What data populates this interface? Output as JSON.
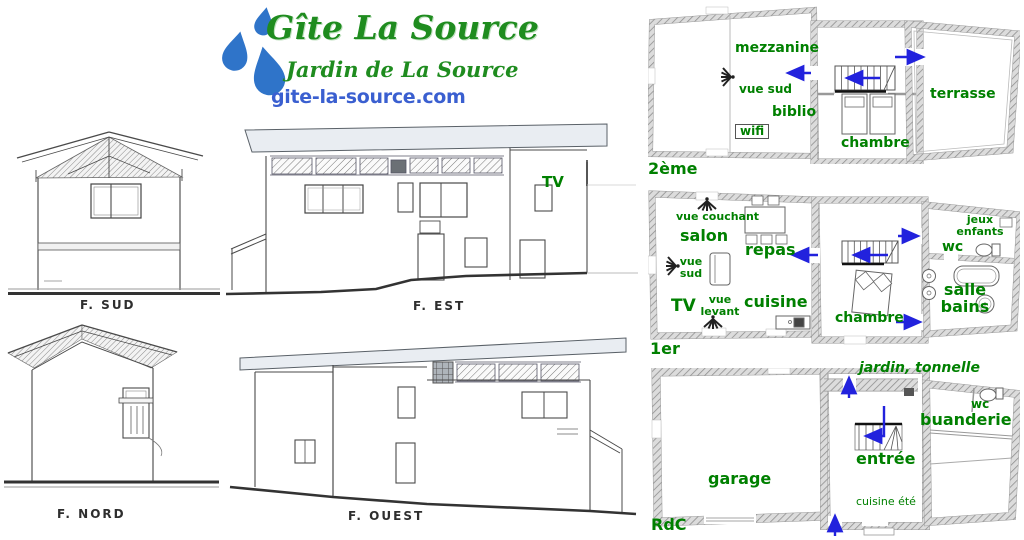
{
  "header": {
    "title": "Gîte La Source",
    "subtitle": "Jardin de La Source",
    "website": "gite-la-source.com",
    "logo_icon": "water-drops-icon"
  },
  "colors": {
    "title_green": "#1f8c1f",
    "website_blue": "#3a5fd0",
    "label_green": "#008000",
    "arrow_blue": "#2222dd",
    "logo_blue": "#2f74c9"
  },
  "elevations": {
    "sud": {
      "label": "F. SUD"
    },
    "est": {
      "label": "F. EST",
      "tv": "TV"
    },
    "nord": {
      "label": "F. NORD"
    },
    "ouest": {
      "label": "F. OUEST"
    }
  },
  "plans": {
    "floor2": {
      "floor_label": "2ème",
      "labels": {
        "mezzanine": "mezzanine",
        "vue_sud": "vue sud",
        "biblio": "biblio",
        "wifi": "wifi",
        "chambre": "chambre",
        "terrasse": "terrasse"
      }
    },
    "floor1": {
      "floor_label": "1er",
      "labels": {
        "vue_couchant": "vue couchant",
        "salon": "salon",
        "repas": "repas",
        "vue_sud": "vue sud",
        "tv": "TV",
        "vue_levant": "vue levant",
        "cuisine": "cuisine",
        "chambre": "chambre",
        "jeux_enfants": "jeux enfants",
        "wc": "wc",
        "salle_bains": "salle bains"
      }
    },
    "ground": {
      "floor_label": "RdC",
      "labels": {
        "jardin_tonnelle": "jardin, tonnelle",
        "wc": "wc",
        "buanderie": "buanderie",
        "entree": "entrée",
        "garage": "garage",
        "cuisine_ete": "cuisine été"
      }
    }
  }
}
